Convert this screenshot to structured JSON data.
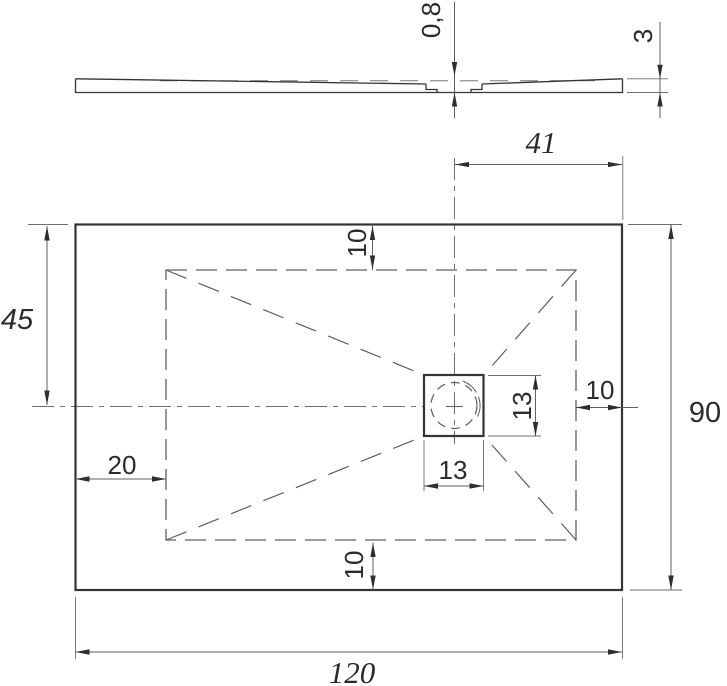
{
  "appearance": {
    "background": "#ffffff",
    "ink_color": "#343434",
    "dim_color": "#5f5f5f"
  },
  "drawing": {
    "profile_view": {
      "dim_recess_depth": "0,8",
      "dim_edge_height": "3"
    },
    "plan_view": {
      "dim_drain_offset_right": "41",
      "dim_center_from_top": "45",
      "dim_inset_top": "10",
      "dim_inset_right": "10",
      "dim_inset_bottom": "10",
      "dim_inset_left": "20",
      "dim_drain_width": "13",
      "dim_drain_height": "13",
      "dim_overall_width": "120",
      "dim_overall_height": "90"
    }
  }
}
